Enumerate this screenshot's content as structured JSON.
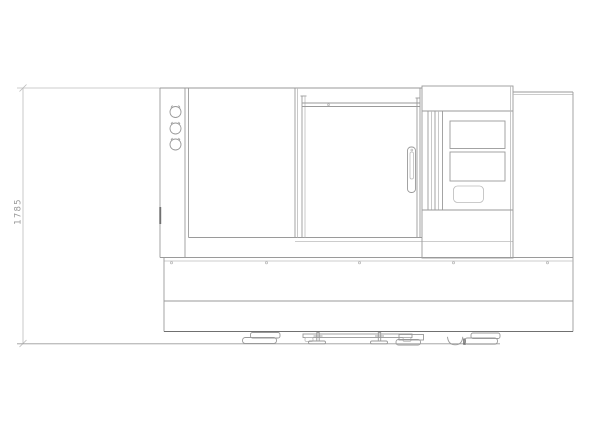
{
  "drawing": {
    "dimension": {
      "label": "1785",
      "value": 1785,
      "orientation": "vertical",
      "measures": "overall-height-floor-to-top"
    },
    "colors": {
      "background": "#ffffff",
      "line": "#9a9a9a",
      "line_light": "#bbbbbb",
      "line_dark": "#707070",
      "dim_text": "#999999"
    }
  }
}
